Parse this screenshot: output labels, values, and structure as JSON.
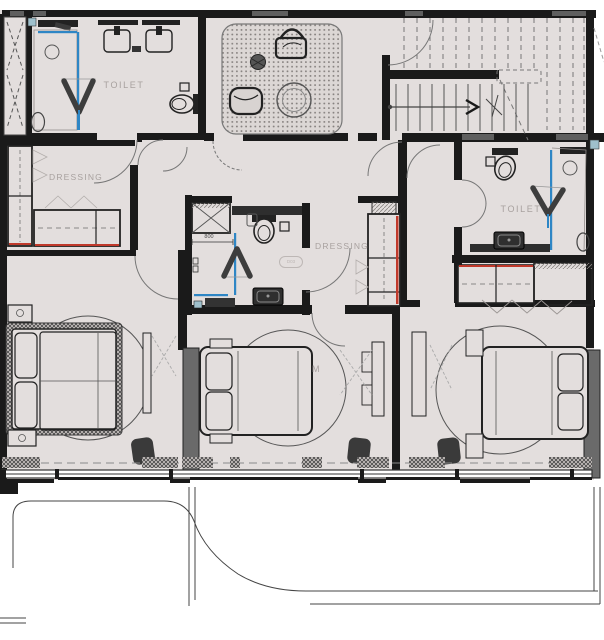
{
  "labels": {
    "toilet_left": "TOILET",
    "dressing_left": "DRESSING",
    "dressing_right": "DRESSING",
    "toilet_right": "TOILET",
    "bedroom_label_partial": "M",
    "bathroom_dim": "800",
    "bathroom_door_tag": "D03"
  },
  "colors": {
    "floor": "#e3dedd",
    "wall": "#1a1a1a",
    "glass-blue": "#2e86c5",
    "accent-red": "#c0392b",
    "label-gray": "#a8a19f",
    "lintel-gray": "#5f5f5f",
    "furniture-dark": "#3a3a3a"
  }
}
